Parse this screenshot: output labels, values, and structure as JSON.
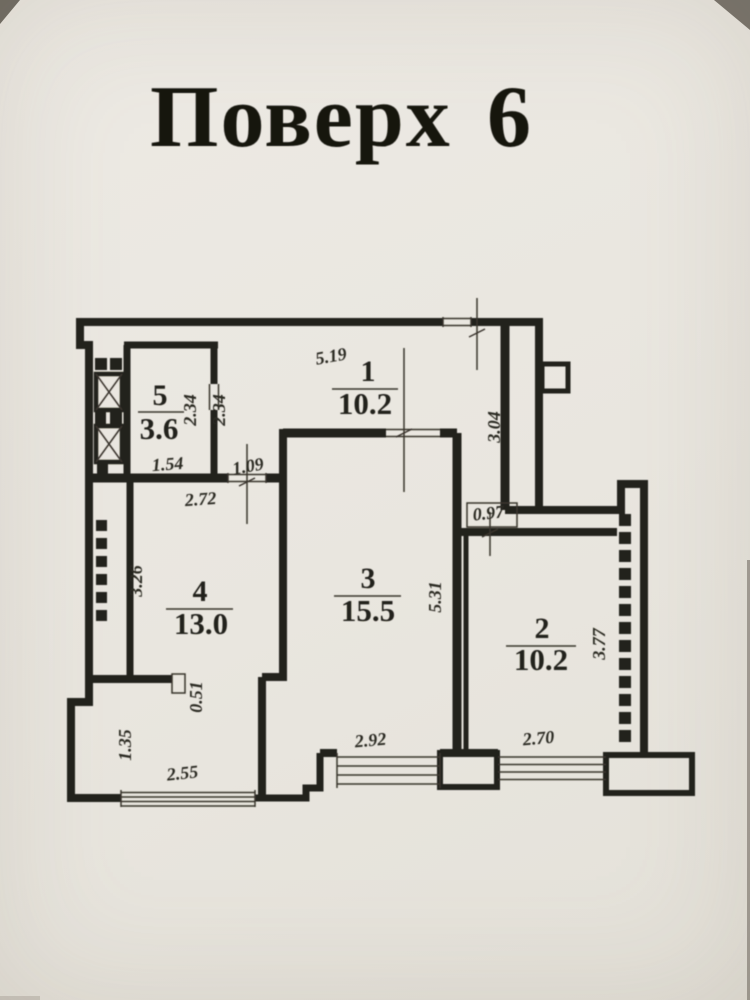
{
  "title": {
    "word": "Поверх",
    "number": "6"
  },
  "plan": {
    "rooms": {
      "r1": {
        "number": "1",
        "area": "10.2"
      },
      "r2": {
        "number": "2",
        "area": "10.2"
      },
      "r3": {
        "number": "3",
        "area": "15.5"
      },
      "r4": {
        "number": "4",
        "area": "13.0"
      },
      "r5": {
        "number": "5",
        "area": "3.6"
      }
    },
    "dims": {
      "d519": "5.19",
      "d234a": "2.34",
      "d234b": "2.34",
      "d304": "3.04",
      "d154": "1.54",
      "d109": "1.09",
      "d272": "2.72",
      "d326": "3.26",
      "d097": "0.97",
      "d531": "5.31",
      "d377": "3.77",
      "d051": "0.51",
      "d135": "1.35",
      "d255": "2.55",
      "d292": "2.92",
      "d270": "2.70"
    }
  }
}
